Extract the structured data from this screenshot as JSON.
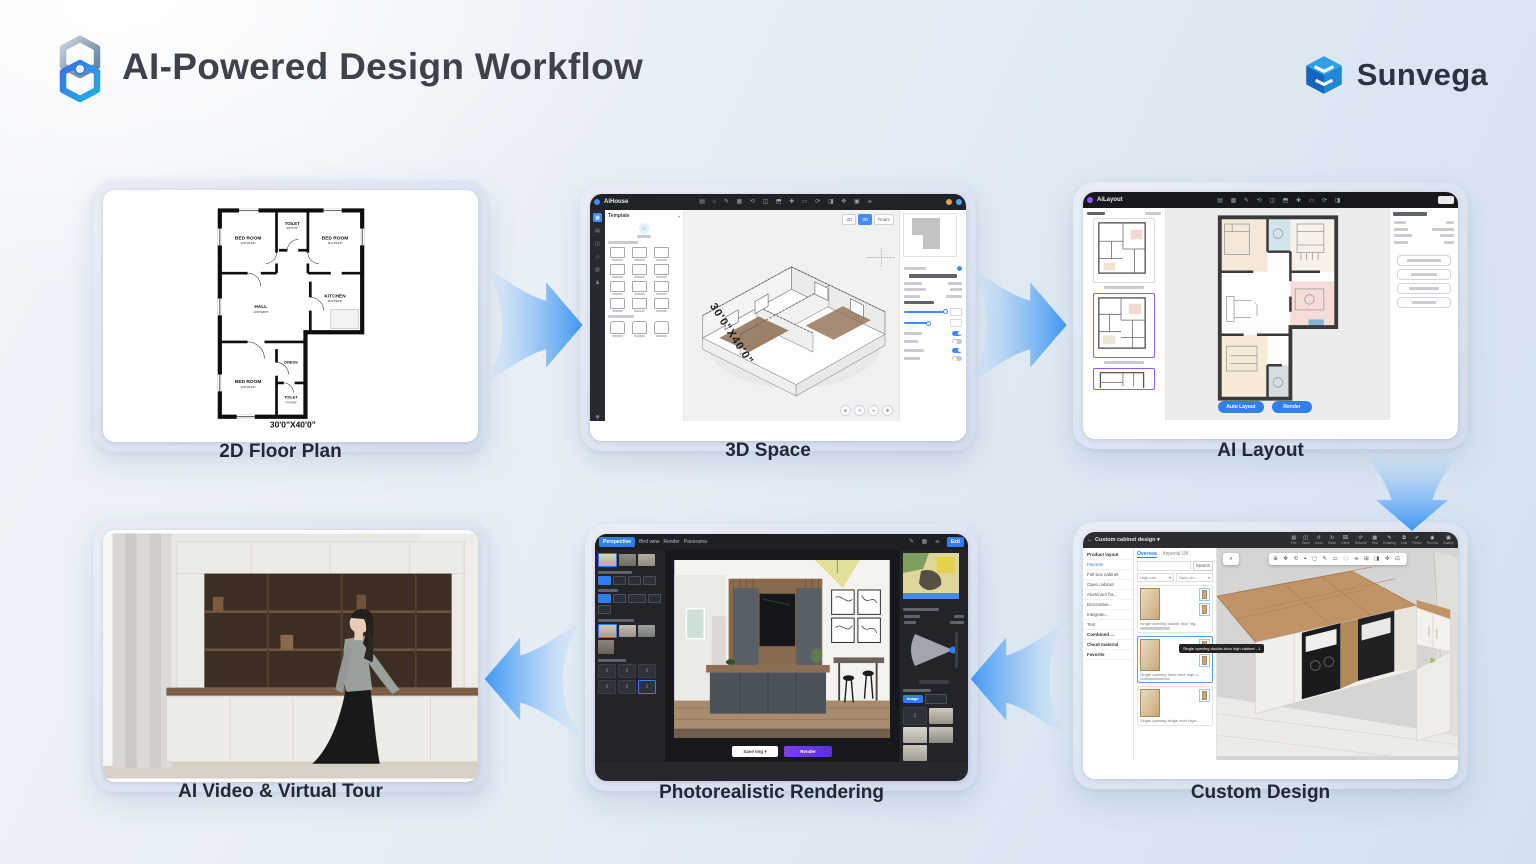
{
  "header": {
    "title": "AI-Powered Design Workflow",
    "brand": "Sunvega"
  },
  "labels": {
    "step1": "2D Floor Plan",
    "step2": "3D Space",
    "step3": "AI Layout",
    "step4": "AI Video & Virtual Tour",
    "step5": "Photorealistic Rendering",
    "step6": "Custom Design"
  },
  "floorplan": {
    "dimension": "30'0\"X40'0\"",
    "rooms": [
      {
        "name": "BED ROOM",
        "dim": "11'0\"X12'6\""
      },
      {
        "name": "TOILET",
        "dim": "4'6\"X7'0\""
      },
      {
        "name": "BED ROOM",
        "dim": "11'0\"X12'6\""
      },
      {
        "name": "HALL",
        "dim": "14'9\"X20'0\""
      },
      {
        "name": "KITCHEN",
        "dim": "11'0\"X10'6\""
      },
      {
        "name": "BED ROOM",
        "dim": "11'0\"X12'0\""
      },
      {
        "name": "DRESS",
        "dim": "4'6\"X5'0\""
      },
      {
        "name": "TOILET",
        "dim": "7'0\"X4'6\""
      }
    ]
  },
  "space3d": {
    "app": "AiHouse",
    "template": "Template",
    "chip2d": "2D",
    "chip3d": "3D",
    "chipmode": "Roam",
    "dimension": "30'0\"X40'0\"",
    "toolbar_glyphs": "▤ ⌂ ✎ ▦ ⟲ ◫ ⬒ ✚ ▭ ⟳ ◨ ✥ ▣ ⌯"
  },
  "ailayout": {
    "app": "AiLayout",
    "toolbar_glyphs": "▤ ▦ ✎ ⟲ ◫ ⬒ ✚ ▭ ⟳ ◨",
    "btn_primary": "Auto Layout",
    "btn_secondary": "Render"
  },
  "rendering": {
    "tabs": [
      "Perspective",
      "Bird view",
      "Render",
      "Panorama"
    ],
    "exit": "Exit",
    "save": "Save Img ▾",
    "render": "Render",
    "chip_image": "Image",
    "chip_pano": "Panora.."
  },
  "custom": {
    "title": "Custom cabinet design ▾",
    "toolbar": [
      {
        "g": "▤",
        "label": "File"
      },
      {
        "g": "◫",
        "label": "Save"
      },
      {
        "g": "↺",
        "label": "Undo"
      },
      {
        "g": "↻",
        "label": "Redo"
      },
      {
        "g": "⌧",
        "label": "Clear"
      },
      {
        "g": "⟳",
        "label": "Rebuild"
      },
      {
        "g": "▦",
        "label": "Test"
      },
      {
        "g": "✎",
        "label": "Drawing"
      },
      {
        "g": "⧉",
        "label": "Link"
      },
      {
        "g": "✔",
        "label": "Finish"
      },
      {
        "g": "◉",
        "label": "Record"
      },
      {
        "g": "▣",
        "label": "Gallery"
      }
    ],
    "menu": [
      "Product layout",
      "Favorite",
      "Full box cabinet",
      "Open cabinet",
      "Aluminum fra...",
      "Decorative...",
      "Integrate...",
      "Test",
      "Combined ...",
      "Cloud material",
      "Favorite"
    ],
    "tab1": "Oversea",
    "tab2": "Imperial UK",
    "search": "Search",
    "dd1": "High cab...",
    "dd2": "Open do...",
    "products": [
      "Single opening double door hig...",
      "Single opening three door high c...",
      "Single opening single door high..."
    ],
    "tooltip": "Single opening double-door high cabinet - 1",
    "canvas_tools": "⊕ ✥ ⟲ ⌖ ◻ ✎ ▭ ⟐ ⌯ ⊞ ◨ ✜ ⊡"
  },
  "icons": {
    "back": "←",
    "caret": "▾",
    "search": "⌕",
    "upload": "↥",
    "magnifier": "⌕"
  },
  "colors": {
    "accent_blue": "#3f97f2",
    "button_blue": "#2f7ef5",
    "render_purple": "#6a35f2",
    "selection_purple": "#8b5cf6",
    "wall_black": "#111111"
  }
}
